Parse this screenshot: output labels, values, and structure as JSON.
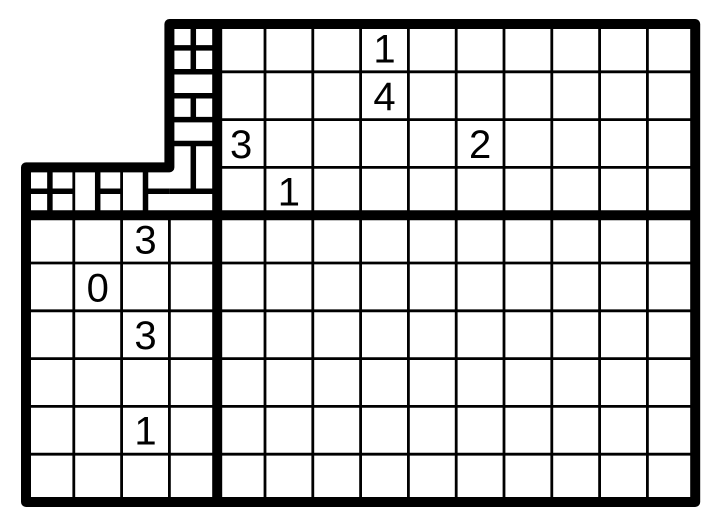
{
  "board": {
    "background_color": "#ffffff",
    "line_color": "#000000",
    "cell_size": 47.8,
    "stroke_widths": {
      "thick": 10,
      "medium": 5.5,
      "thin": 2.8
    },
    "clue_font_size": 40,
    "regions": {
      "top-main": {
        "x": 217.2,
        "y": 24,
        "cols": 10,
        "rows": 4
      },
      "bottom-right": {
        "x": 217.2,
        "y": 215.2,
        "cols": 10,
        "rows": 6
      },
      "bottom-left": {
        "x": 26,
        "y": 215.2,
        "cols": 4,
        "rows": 6
      }
    },
    "outline_points": [
      [
        169.4,
        24
      ],
      [
        695.2,
        24
      ],
      [
        695.2,
        502
      ],
      [
        26,
        502
      ],
      [
        26,
        167.4
      ],
      [
        169.4,
        167.4
      ]
    ],
    "thick_lines": [
      [
        217.2,
        24,
        217.2,
        502
      ],
      [
        26,
        215.2,
        695.2,
        215.2
      ]
    ],
    "medium_lines": [
      [
        169.4,
        47.9,
        217.2,
        47.9
      ],
      [
        169.4,
        71.8,
        217.2,
        71.8
      ],
      [
        169.4,
        95.7,
        217.2,
        95.7
      ],
      [
        169.4,
        119.6,
        217.2,
        119.6
      ],
      [
        169.4,
        143.5,
        217.2,
        143.5
      ],
      [
        169.4,
        191.3,
        217.2,
        191.3
      ],
      [
        193.3,
        24,
        193.3,
        71.8
      ],
      [
        193.3,
        95.7,
        193.3,
        119.6
      ],
      [
        193.3,
        143.5,
        193.3,
        191.3
      ],
      [
        49.9,
        167.4,
        49.9,
        215.2
      ],
      [
        97.7,
        167.4,
        97.7,
        215.2
      ],
      [
        145.5,
        167.4,
        145.5,
        215.2
      ],
      [
        26,
        191.3,
        73.8,
        191.3
      ],
      [
        97.7,
        191.3,
        121.6,
        191.3
      ],
      [
        145.5,
        191.3,
        169.4,
        191.3
      ]
    ],
    "fine_thin_lines": [
      [
        73.8,
        167.4,
        73.8,
        215.2
      ],
      [
        121.6,
        167.4,
        121.6,
        215.2
      ]
    ],
    "clues": [
      {
        "region": "top-main",
        "col": 4,
        "row": 1,
        "value": "1"
      },
      {
        "region": "top-main",
        "col": 4,
        "row": 2,
        "value": "4"
      },
      {
        "region": "top-main",
        "col": 1,
        "row": 3,
        "value": "3"
      },
      {
        "region": "top-main",
        "col": 6,
        "row": 3,
        "value": "2"
      },
      {
        "region": "top-main",
        "col": 2,
        "row": 4,
        "value": "1"
      },
      {
        "region": "bottom-left",
        "col": 3,
        "row": 1,
        "value": "3"
      },
      {
        "region": "bottom-left",
        "col": 2,
        "row": 2,
        "value": "0"
      },
      {
        "region": "bottom-left",
        "col": 3,
        "row": 3,
        "value": "3"
      },
      {
        "region": "bottom-left",
        "col": 3,
        "row": 5,
        "value": "1"
      }
    ]
  }
}
